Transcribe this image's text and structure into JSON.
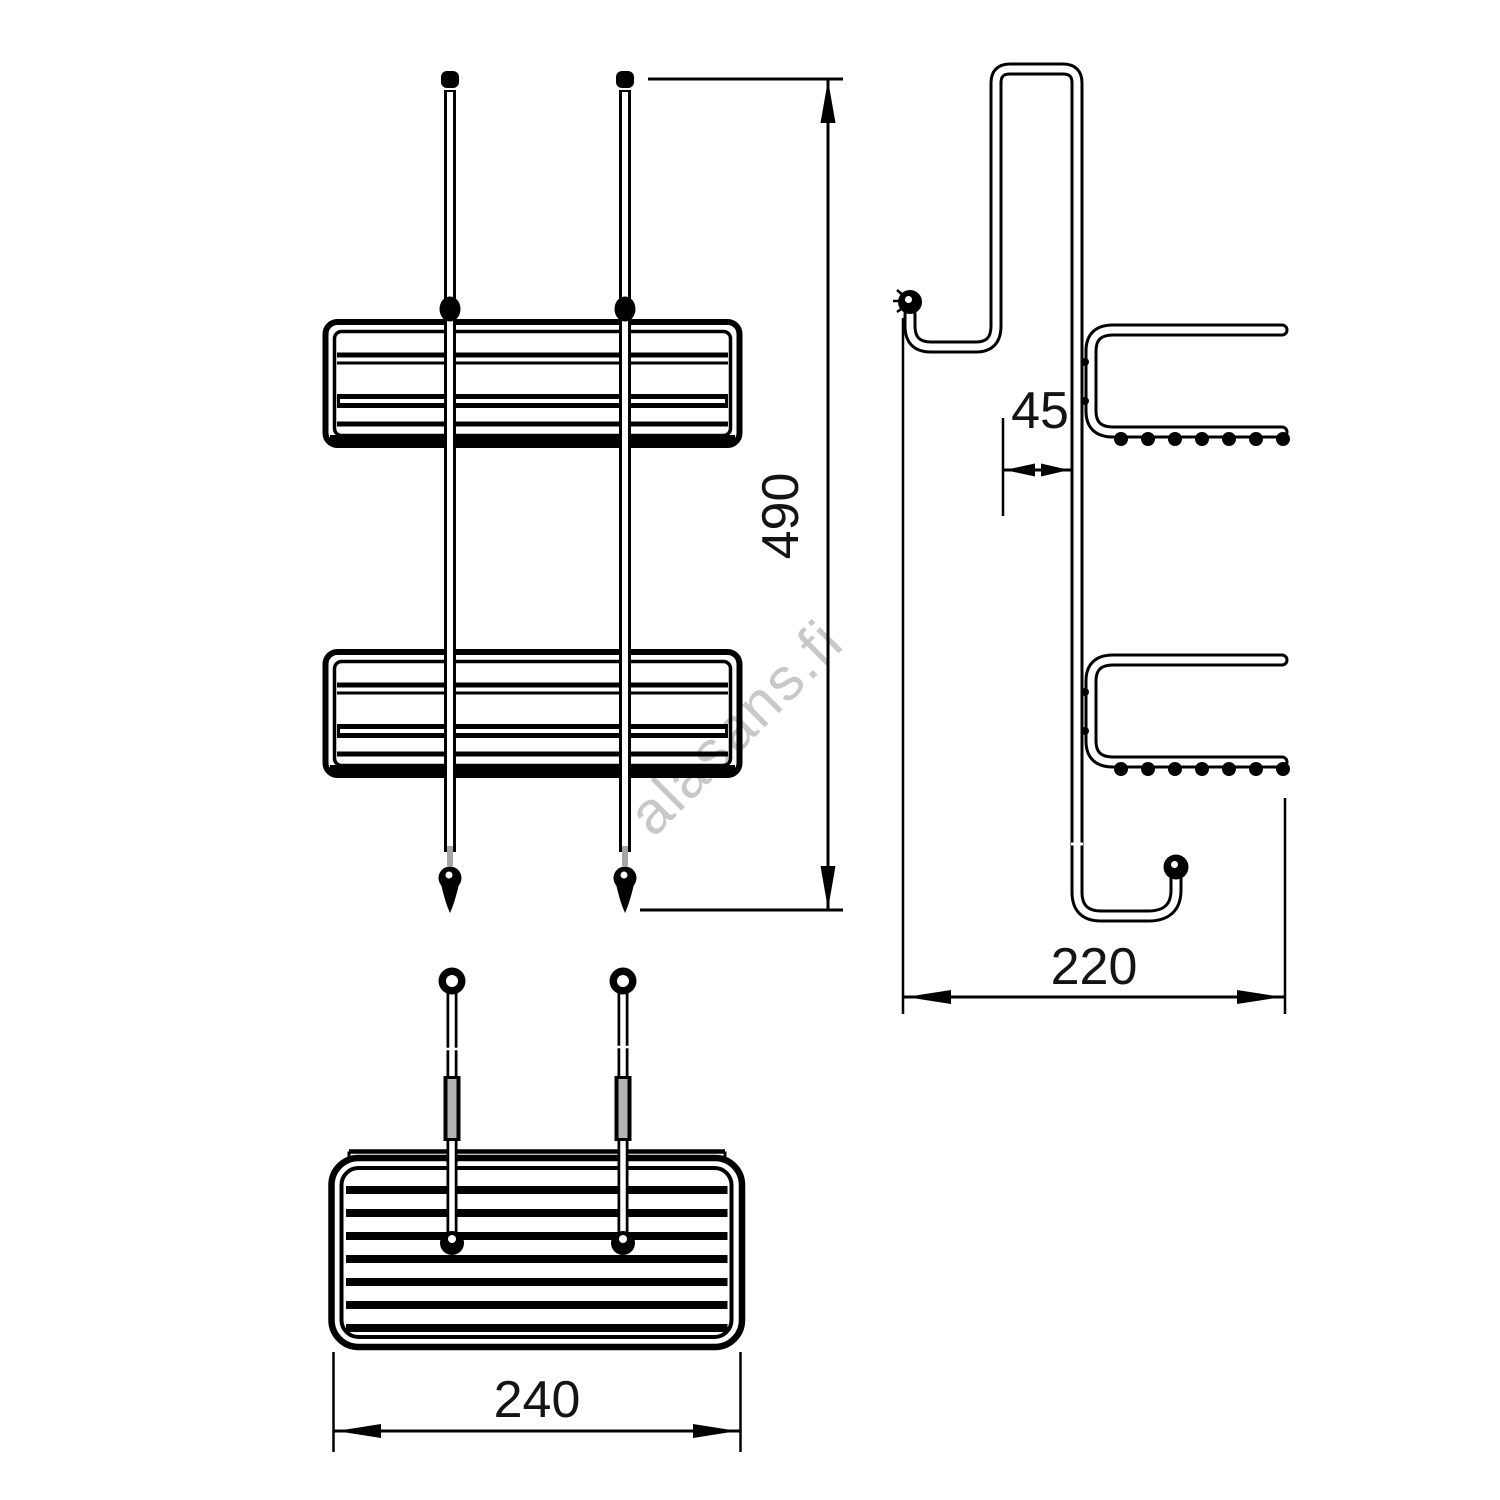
{
  "watermark": {
    "text": "alasans.fi",
    "color": "#c8c8c8"
  },
  "drawing": {
    "line_color": "#000000",
    "background": "#ffffff",
    "sleeve_color": "#a6a6a6"
  },
  "dimensions": {
    "overall_height": {
      "value": "490"
    },
    "hook_opening": {
      "value": "45"
    },
    "side_depth": {
      "value": "220"
    },
    "basket_width": {
      "value": "240"
    }
  }
}
